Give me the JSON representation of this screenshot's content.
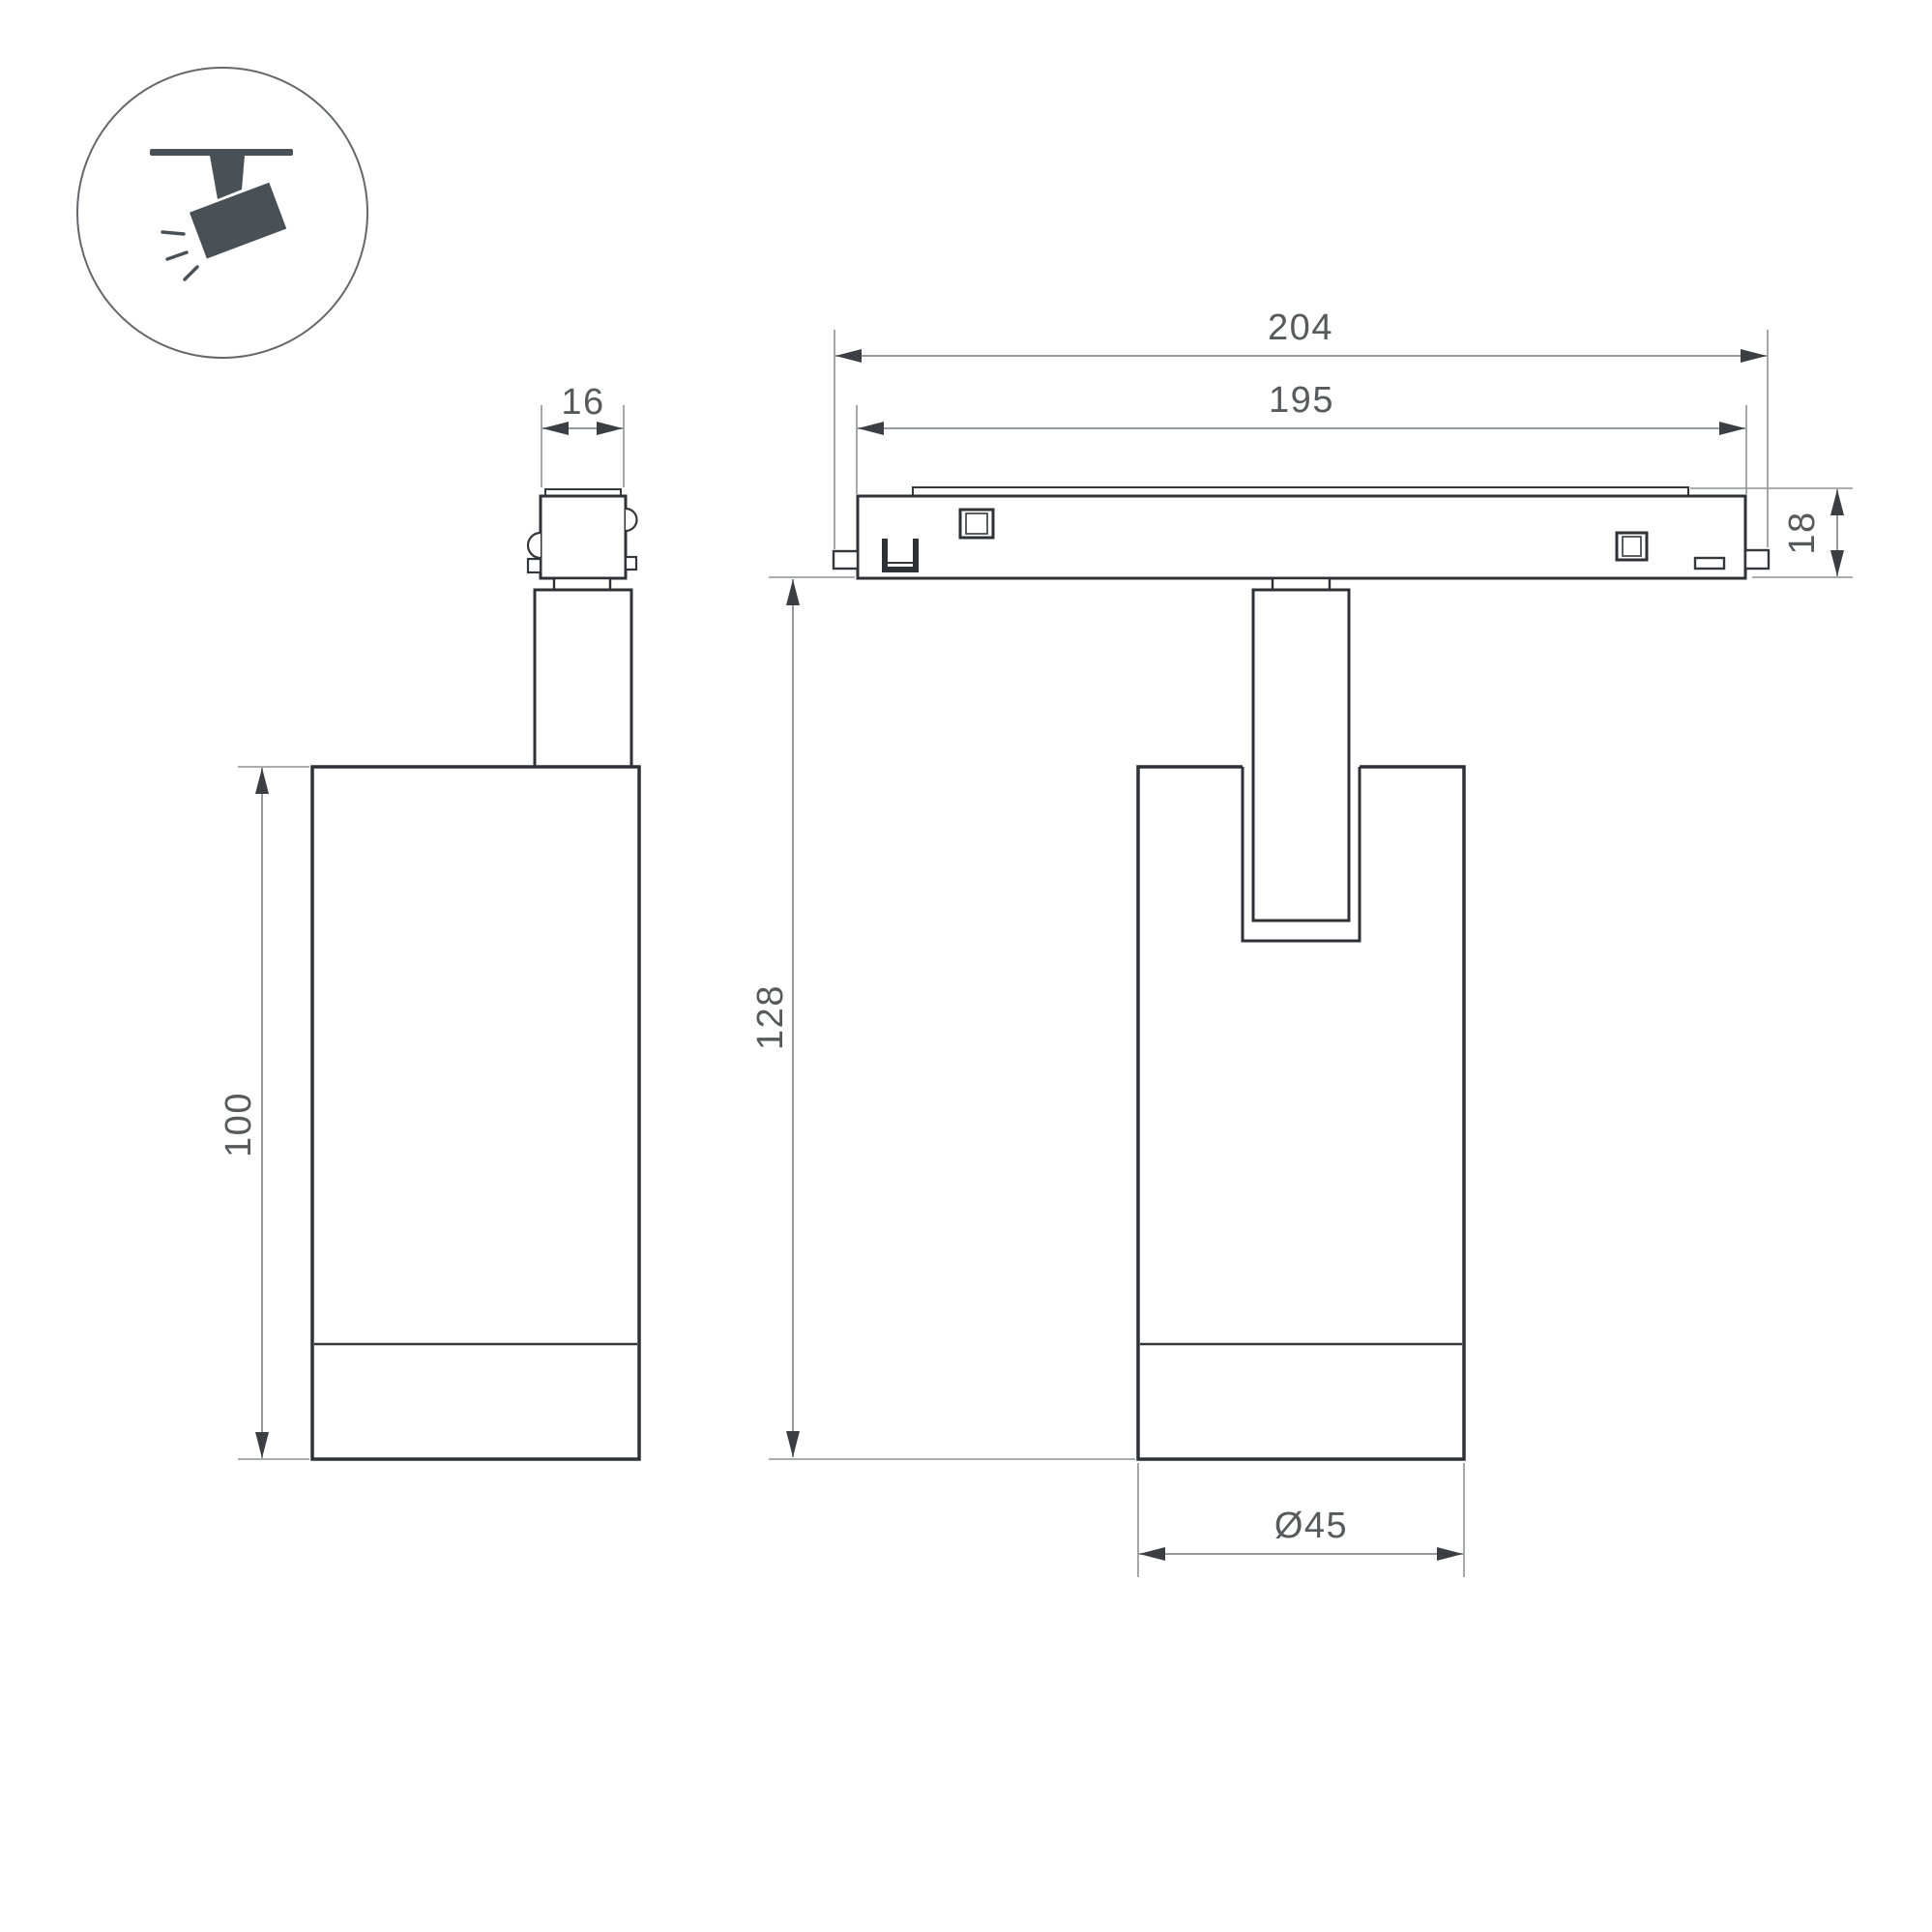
{
  "icon": {
    "name": "ceiling-track-spotlight-pictogram"
  },
  "dimensions": {
    "track_length_outer": {
      "label": "204"
    },
    "track_length_inner": {
      "label": "195"
    },
    "track_height": {
      "label": "18"
    },
    "overall_height": {
      "label": "128"
    },
    "body_height": {
      "label": "100"
    },
    "adapter_width": {
      "label": "16"
    },
    "body_diameter": {
      "label": "Ø45"
    }
  },
  "colors": {
    "background": "#ffffff",
    "outline": "#2e3236",
    "dimension_line": "#8a8d90",
    "dimension_text": "#57595c",
    "arrow": "#3b3f43",
    "icon": "#495056"
  }
}
